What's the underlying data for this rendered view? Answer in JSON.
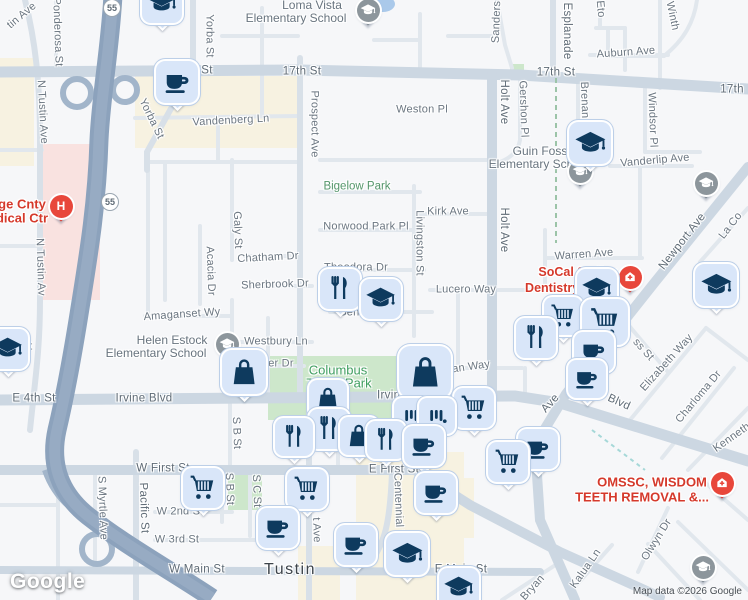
{
  "map": {
    "city": "Tustin",
    "watermark": "Google",
    "attribution": "Map data ©2026 Google",
    "colors": {
      "freeway": "#8ca2bc",
      "arterial": "#ccd7e2",
      "minor_road": "#e1e7ed",
      "park": "#cde7cb",
      "commercial": "#f7f2e1",
      "hospital_area": "#f9e2e0",
      "water": "#aac9ea",
      "pin_fill": "#d9e6f9",
      "pin_glyph": "#0e3a5e",
      "poi_red": "#d5392b",
      "park_label": "#3f9e5f",
      "school_label": "#68747f",
      "street_label": "#6b7681",
      "gray_marker": "#8d969c",
      "red_marker": "#e8473b"
    },
    "route_shields": [
      {
        "t": "55",
        "x": 112,
        "y": 8
      },
      {
        "t": "55",
        "x": 110,
        "y": 202
      }
    ],
    "labels": [
      {
        "t": "Loma Vista",
        "x": 312,
        "y": 5,
        "k": "sch"
      },
      {
        "t": "Elementary School",
        "x": 296,
        "y": 18,
        "k": "sch"
      },
      {
        "t": "17th St",
        "x": 302,
        "y": 72,
        "k": "maj"
      },
      {
        "t": "St",
        "x": 207,
        "y": 71,
        "k": "maj"
      },
      {
        "t": "17th St",
        "x": 556,
        "y": 73,
        "k": "maj"
      },
      {
        "t": "17th",
        "x": 732,
        "y": 90,
        "k": "maj"
      },
      {
        "t": "Yorba St",
        "x": 209,
        "y": 36,
        "r": 90,
        "k": "st"
      },
      {
        "t": "Yorba St",
        "x": 151,
        "y": 119,
        "r": 64,
        "k": "st"
      },
      {
        "t": "Ponderosa St",
        "x": 57,
        "y": 32,
        "r": 88,
        "k": "st"
      },
      {
        "t": "tin Ave",
        "x": 22,
        "y": 16,
        "r": -40,
        "k": "st"
      },
      {
        "t": "N Tustin Ave",
        "x": 42,
        "y": 112,
        "r": 87,
        "k": "st"
      },
      {
        "t": "N Tustin Av",
        "x": 40,
        "y": 267,
        "r": 88,
        "k": "st"
      },
      {
        "t": "Vandenberg Ln",
        "x": 231,
        "y": 121,
        "r": -3,
        "k": "st"
      },
      {
        "t": "Prospect Ave",
        "x": 314,
        "y": 124,
        "r": 90,
        "k": "st"
      },
      {
        "t": "Sanders",
        "x": 497,
        "y": 22,
        "r": -88,
        "k": "st"
      },
      {
        "t": "Esplanade",
        "x": 566,
        "y": 31,
        "r": 90,
        "k": "maj"
      },
      {
        "t": "Eto",
        "x": 600,
        "y": 9,
        "r": 85,
        "k": "st"
      },
      {
        "t": "Winth",
        "x": 672,
        "y": 16,
        "r": 78,
        "k": "st"
      },
      {
        "t": "Auburn Ave",
        "x": 626,
        "y": 53,
        "r": -4,
        "k": "st"
      },
      {
        "t": "Weston Pl",
        "x": 422,
        "y": 110,
        "k": "st"
      },
      {
        "t": "Holt Ave",
        "x": 503,
        "y": 102,
        "r": 90,
        "k": "maj"
      },
      {
        "t": "Gershon Pl",
        "x": 523,
        "y": 109,
        "r": 88,
        "k": "st"
      },
      {
        "t": "Brenan",
        "x": 584,
        "y": 100,
        "r": 88,
        "k": "st"
      },
      {
        "t": "Windsor Pl",
        "x": 652,
        "y": 120,
        "r": 88,
        "k": "st"
      },
      {
        "t": "Vanderlip Ave",
        "x": 655,
        "y": 161,
        "r": -5,
        "k": "st"
      },
      {
        "t": "Guin Foss",
        "x": 540,
        "y": 151,
        "k": "sch"
      },
      {
        "t": "Elementary School",
        "x": 539,
        "y": 164,
        "k": "sch"
      },
      {
        "t": "Bigelow Park",
        "x": 357,
        "y": 187,
        "k": "park"
      },
      {
        "t": "Kirk Ave",
        "x": 448,
        "y": 212,
        "k": "st"
      },
      {
        "t": "Norwood Park Pl",
        "x": 366,
        "y": 227,
        "k": "st"
      },
      {
        "t": "Livingston St",
        "x": 419,
        "y": 243,
        "r": 90,
        "k": "st"
      },
      {
        "t": "Holt Ave",
        "x": 503,
        "y": 230,
        "r": 90,
        "k": "maj"
      },
      {
        "t": "Galy St",
        "x": 237,
        "y": 230,
        "r": 88,
        "k": "st"
      },
      {
        "t": "Chatham Dr",
        "x": 268,
        "y": 258,
        "r": -3,
        "k": "st"
      },
      {
        "t": "Sherbrook Dr",
        "x": 275,
        "y": 285,
        "r": -2,
        "k": "st"
      },
      {
        "t": "Acacia Dr",
        "x": 210,
        "y": 271,
        "r": 88,
        "k": "st"
      },
      {
        "t": "Theodora Dr",
        "x": 356,
        "y": 268,
        "k": "st"
      },
      {
        "t": "Lucero Way",
        "x": 466,
        "y": 290,
        "k": "st"
      },
      {
        "t": "Warren Ave",
        "x": 584,
        "y": 255,
        "r": -4,
        "k": "st"
      },
      {
        "t": "Newport Ave",
        "x": 683,
        "y": 242,
        "r": -52,
        "k": "maj"
      },
      {
        "t": "La Co",
        "x": 731,
        "y": 226,
        "r": -52,
        "k": "st"
      },
      {
        "t": "SoCal Smiles",
        "x": 578,
        "y": 272,
        "k": "red"
      },
      {
        "t": "Dentistry at T",
        "x": 565,
        "y": 288,
        "k": "red"
      },
      {
        "t": "Amaganset Wy",
        "x": 182,
        "y": 315,
        "r": -4,
        "k": "st"
      },
      {
        "t": "Helen Estock",
        "x": 172,
        "y": 340,
        "k": "sch"
      },
      {
        "t": "Elementary School",
        "x": 156,
        "y": 353,
        "k": "sch"
      },
      {
        "t": "Westbury Ln",
        "x": 276,
        "y": 342,
        "k": "st"
      },
      {
        "t": "iller Dr",
        "x": 277,
        "y": 364,
        "k": "st"
      },
      {
        "t": "Beneta Wy",
        "x": 367,
        "y": 313,
        "k": "st"
      },
      {
        "t": "ss St",
        "x": 643,
        "y": 350,
        "r": 48,
        "k": "st"
      },
      {
        "t": "Elizabeth Way",
        "x": 667,
        "y": 363,
        "r": -48,
        "k": "st"
      },
      {
        "t": "Columbus",
        "x": 338,
        "y": 370,
        "k": "parklg"
      },
      {
        "t": "Tustin Park",
        "x": 339,
        "y": 383,
        "k": "parklg"
      },
      {
        "t": "St",
        "x": 27,
        "y": 347,
        "k": "st"
      },
      {
        "t": "E 4th St",
        "x": 34,
        "y": 399,
        "k": "maj"
      },
      {
        "t": "Irvine Blvd",
        "x": 144,
        "y": 399,
        "k": "maj"
      },
      {
        "t": "Irvine",
        "x": 392,
        "y": 396,
        "k": "maj"
      },
      {
        "t": "e Blvd",
        "x": 614,
        "y": 401,
        "r": 24,
        "k": "maj"
      },
      {
        "t": "Ave",
        "x": 551,
        "y": 404,
        "r": -48,
        "k": "maj"
      },
      {
        "t": "illian Way",
        "x": 466,
        "y": 368,
        "r": -8,
        "k": "st"
      },
      {
        "t": "Charloma Dr",
        "x": 699,
        "y": 397,
        "r": -50,
        "k": "st"
      },
      {
        "t": "Kenneth",
        "x": 732,
        "y": 438,
        "r": -35,
        "k": "st"
      },
      {
        "t": "OMSSC, WISDOM",
        "x": 652,
        "y": 482,
        "k": "redlg"
      },
      {
        "t": "TEETH REMOVAL &...",
        "x": 642,
        "y": 497,
        "k": "redlg"
      },
      {
        "t": "W First St",
        "x": 163,
        "y": 469,
        "k": "maj"
      },
      {
        "t": "E First St",
        "x": 394,
        "y": 470,
        "k": "maj"
      },
      {
        "t": "S Myrtle Ave",
        "x": 102,
        "y": 508,
        "r": 88,
        "k": "st"
      },
      {
        "t": "Pacific St",
        "x": 143,
        "y": 508,
        "r": 88,
        "k": "maj"
      },
      {
        "t": "S B St",
        "x": 236,
        "y": 433,
        "r": 88,
        "k": "st"
      },
      {
        "t": "S B St",
        "x": 229,
        "y": 489,
        "r": 88,
        "k": "st"
      },
      {
        "t": "S C St",
        "x": 256,
        "y": 491,
        "r": 88,
        "k": "st"
      },
      {
        "t": "t Ave",
        "x": 316,
        "y": 530,
        "r": 88,
        "k": "st"
      },
      {
        "t": "Centennial W",
        "x": 398,
        "y": 507,
        "r": 88,
        "k": "st"
      },
      {
        "t": "st St",
        "x": 425,
        "y": 494,
        "r": 40,
        "k": "st"
      },
      {
        "t": "W 2nd St",
        "x": 180,
        "y": 512,
        "k": "st"
      },
      {
        "t": "W 3rd St",
        "x": 177,
        "y": 540,
        "k": "st"
      },
      {
        "t": "W Main St",
        "x": 197,
        "y": 570,
        "k": "maj"
      },
      {
        "t": "Tustin",
        "x": 290,
        "y": 570,
        "k": "city"
      },
      {
        "t": "E Main St",
        "x": 461,
        "y": 570,
        "k": "maj"
      },
      {
        "t": "Olwyn Dr",
        "x": 657,
        "y": 540,
        "r": -58,
        "k": "st"
      },
      {
        "t": "Kalua Ln",
        "x": 586,
        "y": 569,
        "r": -55,
        "k": "st"
      },
      {
        "t": "Bryan",
        "x": 533,
        "y": 588,
        "r": -48,
        "k": "st"
      },
      {
        "t": "ge Cnty",
        "x": 22,
        "y": 204,
        "k": "redlg"
      },
      {
        "t": "dical Ctr",
        "x": 22,
        "y": 218,
        "k": "redlg"
      }
    ],
    "pins": [
      {
        "type": "school",
        "icon": "graduation-cap-icon",
        "x": 162,
        "y": 3,
        "s": 40
      },
      {
        "type": "coffee",
        "icon": "coffee-cup-icon",
        "x": 177,
        "y": 82,
        "s": 42
      },
      {
        "type": "school",
        "icon": "graduation-cap-icon",
        "x": 590,
        "y": 143,
        "s": 42
      },
      {
        "type": "restaurant",
        "icon": "fork-knife-icon",
        "x": 340,
        "y": 289,
        "s": 40
      },
      {
        "type": "school",
        "icon": "graduation-cap-icon",
        "x": 381,
        "y": 299,
        "s": 40
      },
      {
        "type": "school",
        "icon": "graduation-cap-icon",
        "x": 597,
        "y": 289,
        "s": 40
      },
      {
        "type": "school",
        "icon": "graduation-cap-icon",
        "x": 716,
        "y": 285,
        "s": 42
      },
      {
        "type": "school",
        "icon": "graduation-cap-icon",
        "x": 8,
        "y": 349,
        "s": 40
      },
      {
        "type": "bag",
        "icon": "shopping-bag-icon",
        "x": 244,
        "y": 372,
        "s": 44
      },
      {
        "type": "cart",
        "icon": "shopping-cart-icon",
        "x": 563,
        "y": 316,
        "s": 38
      },
      {
        "type": "cart",
        "icon": "shopping-cart-icon",
        "x": 605,
        "y": 322,
        "s": 46
      },
      {
        "type": "restaurant",
        "icon": "fork-knife-icon",
        "x": 536,
        "y": 338,
        "s": 40
      },
      {
        "type": "coffee",
        "icon": "coffee-cup-icon",
        "x": 594,
        "y": 352,
        "s": 40
      },
      {
        "type": "coffee",
        "icon": "coffee-cup-icon",
        "x": 587,
        "y": 379,
        "s": 38
      },
      {
        "type": "bag",
        "icon": "shopping-bag-icon",
        "x": 425,
        "y": 372,
        "s": 52
      },
      {
        "type": "bag",
        "icon": "shopping-bag-icon",
        "x": 328,
        "y": 399,
        "s": 38
      },
      {
        "type": "cart",
        "icon": "shopping-cart-icon",
        "x": 474,
        "y": 408,
        "s": 40
      },
      {
        "type": "store",
        "icon": "store-bars-icon",
        "x": 412,
        "y": 416,
        "s": 36
      },
      {
        "type": "store",
        "icon": "store-bars-icon",
        "x": 437,
        "y": 416,
        "s": 36
      },
      {
        "type": "restaurant",
        "icon": "fork-knife-icon",
        "x": 329,
        "y": 429,
        "s": 40
      },
      {
        "type": "bag",
        "icon": "shopping-bag-icon",
        "x": 359,
        "y": 436,
        "s": 38
      },
      {
        "type": "restaurant",
        "icon": "fork-knife-icon",
        "x": 294,
        "y": 437,
        "s": 38
      },
      {
        "type": "restaurant",
        "icon": "fork-knife-icon",
        "x": 386,
        "y": 440,
        "s": 38
      },
      {
        "type": "coffee",
        "icon": "coffee-cup-icon",
        "x": 424,
        "y": 446,
        "s": 40
      },
      {
        "type": "coffee",
        "icon": "coffee-cup-icon",
        "x": 538,
        "y": 449,
        "s": 40
      },
      {
        "type": "cart",
        "icon": "shopping-cart-icon",
        "x": 508,
        "y": 462,
        "s": 40
      },
      {
        "type": "cart",
        "icon": "shopping-cart-icon",
        "x": 203,
        "y": 488,
        "s": 40
      },
      {
        "type": "cart",
        "icon": "shopping-cart-icon",
        "x": 307,
        "y": 489,
        "s": 40
      },
      {
        "type": "coffee",
        "icon": "coffee-cup-icon",
        "x": 436,
        "y": 493,
        "s": 40
      },
      {
        "type": "coffee",
        "icon": "coffee-cup-icon",
        "x": 278,
        "y": 528,
        "s": 40
      },
      {
        "type": "coffee",
        "icon": "coffee-cup-icon",
        "x": 356,
        "y": 545,
        "s": 40
      },
      {
        "type": "school",
        "icon": "graduation-cap-icon",
        "x": 407,
        "y": 554,
        "s": 42
      },
      {
        "type": "school",
        "icon": "graduation-cap-icon",
        "x": 459,
        "y": 588,
        "s": 40
      }
    ],
    "circle_markers": [
      {
        "type": "school-gray",
        "icon": "graduation-cap-icon",
        "x": 368,
        "y": 10
      },
      {
        "type": "school-gray",
        "icon": "graduation-cap-icon",
        "x": 580,
        "y": 171
      },
      {
        "type": "school-gray",
        "icon": "graduation-cap-icon",
        "x": 706,
        "y": 183
      },
      {
        "type": "school-gray",
        "icon": "graduation-cap-icon",
        "x": 227,
        "y": 344
      },
      {
        "type": "school-gray",
        "icon": "graduation-cap-icon",
        "x": 703,
        "y": 567
      },
      {
        "type": "medical-red",
        "icon": "medical-cross-icon",
        "x": 630,
        "y": 277
      },
      {
        "type": "medical-red",
        "icon": "medical-cross-icon",
        "x": 722,
        "y": 483
      },
      {
        "type": "hospital-red",
        "icon": "hospital-h-icon",
        "x": 61,
        "y": 206,
        "t": "H"
      }
    ]
  }
}
